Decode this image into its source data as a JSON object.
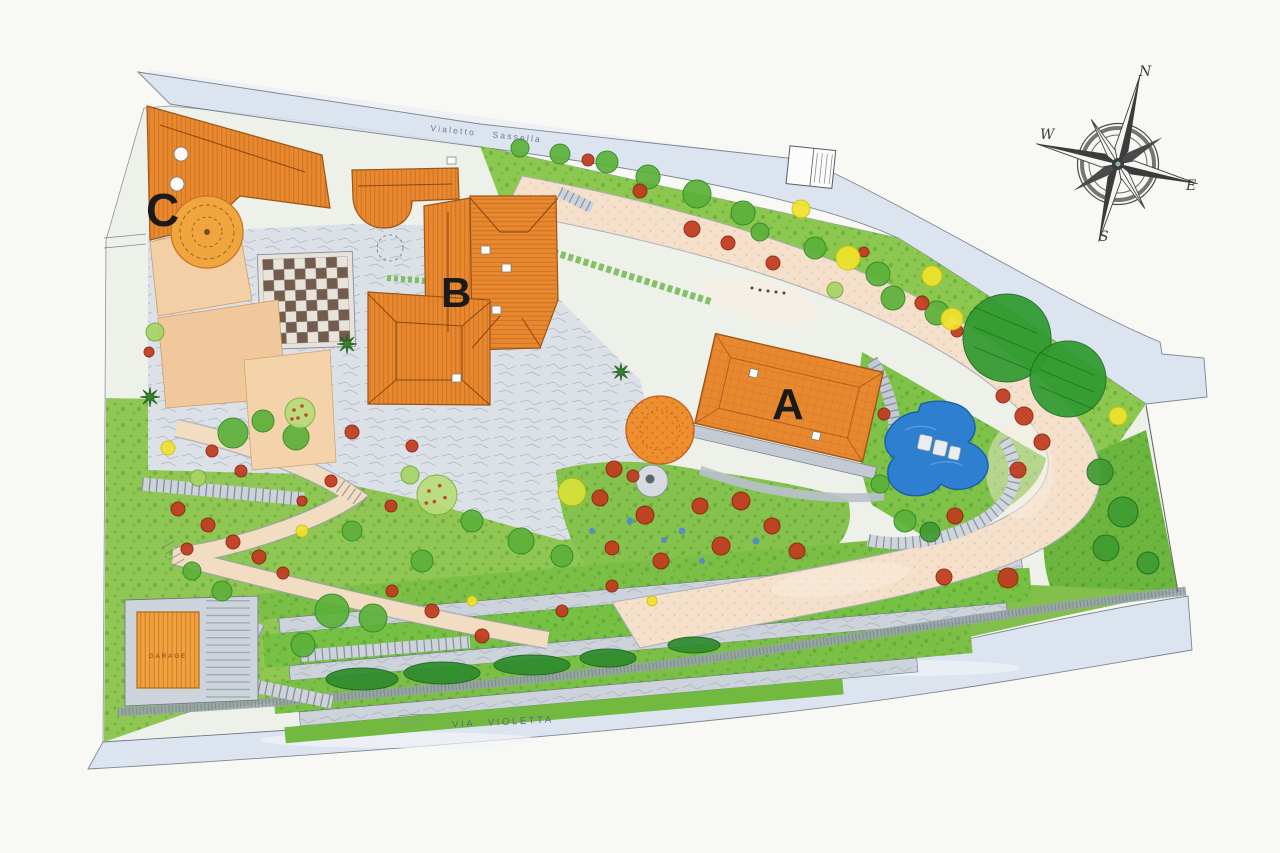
{
  "plan": {
    "type": "hand-drawn landscape site plan",
    "streets": {
      "top": "Vialetto Sassella",
      "bottom": "VIA VIOLETTA"
    },
    "buildings": {
      "a": "A",
      "b": "B",
      "c": "C",
      "garage": "GARAGE"
    },
    "compass": {
      "north": "N",
      "east": "E",
      "south": "S",
      "west": "W"
    },
    "palette": {
      "paper": "#f8f8f5",
      "street_blue": "#d8e2ee",
      "property_base": "#eef0ea",
      "roof_orange": "#e8892f",
      "roof_hatch": "#b85a18",
      "roof_light": "#efa23d",
      "tower_orange": "#f0a53e",
      "terrace_peach": "#f3cfa6",
      "driveway": "#f5e0cb",
      "courtyard_grey": "#dce1e8",
      "path_grey": "#ccd3da",
      "garden_green": "#8cc850",
      "tree_green": "#5cb13a",
      "tree_dark": "#3f9b33",
      "bush_red": "#c13a1e",
      "tree_yellow": "#f0e32b",
      "pool_blue": "#2e7fd0",
      "checker_dark": "#6a5140",
      "checker_light": "#eae4d8",
      "ink": "#1a1a1a"
    },
    "checkerboard": {
      "rows": 8,
      "cols": 8
    },
    "vegetation": [
      [
        "tree",
        520,
        148,
        9
      ],
      [
        "tree",
        560,
        154,
        10
      ],
      [
        "tree",
        607,
        162,
        11
      ],
      [
        "tree",
        648,
        177,
        12
      ],
      [
        "tree",
        697,
        194,
        14
      ],
      [
        "tree",
        743,
        213,
        12
      ],
      [
        "tree",
        815,
        248,
        11
      ],
      [
        "tree",
        878,
        274,
        12
      ],
      [
        "tree",
        893,
        298,
        12
      ],
      [
        "tree",
        937,
        313,
        12
      ],
      [
        "tree",
        760,
        232,
        9
      ],
      [
        "bush-red",
        588,
        160,
        6
      ],
      [
        "bush-red",
        640,
        191,
        7
      ],
      [
        "bush-red",
        692,
        229,
        8
      ],
      [
        "bush-red",
        728,
        243,
        7
      ],
      [
        "bush-red",
        773,
        263,
        7
      ],
      [
        "bush-red",
        864,
        252,
        5
      ],
      [
        "bush-red",
        922,
        303,
        7
      ],
      [
        "bush-red",
        957,
        331,
        6
      ],
      [
        "tree-yellow",
        801,
        209,
        9
      ],
      [
        "tree-yellow",
        848,
        258,
        12
      ],
      [
        "tree-yellow",
        932,
        276,
        10
      ],
      [
        "tree-yellow",
        952,
        319,
        11
      ],
      [
        "tree-yellow",
        1118,
        416,
        9
      ],
      [
        "tree-big",
        1007,
        338,
        44
      ],
      [
        "tree-big",
        1068,
        379,
        38
      ],
      [
        "tree-light",
        835,
        290,
        8
      ],
      [
        "bush-red",
        1003,
        396,
        7
      ],
      [
        "bush-red",
        1024,
        416,
        9
      ],
      [
        "bush-red",
        1042,
        442,
        8
      ],
      [
        "bush-red",
        955,
        516,
        8
      ],
      [
        "bush-red",
        884,
        414,
        6
      ],
      [
        "bush-red",
        1018,
        470,
        8
      ],
      [
        "tree",
        905,
        521,
        11
      ],
      [
        "tree",
        880,
        484,
        9
      ],
      [
        "tree-dark",
        930,
        532,
        10
      ],
      [
        "tree-dark",
        1100,
        472,
        13
      ],
      [
        "tree-dark",
        1123,
        512,
        15
      ],
      [
        "tree-dark",
        1106,
        548,
        13
      ],
      [
        "tree-dark",
        1148,
        563,
        11
      ],
      [
        "bush-red",
        1008,
        578,
        10
      ],
      [
        "bush-red",
        944,
        577,
        8
      ],
      [
        "bush-yellow",
        572,
        492,
        14
      ],
      [
        "bush-red",
        600,
        498,
        8
      ],
      [
        "bush-red",
        645,
        515,
        9
      ],
      [
        "bush-red",
        700,
        506,
        8
      ],
      [
        "bush-red",
        741,
        501,
        9
      ],
      [
        "bush-red",
        772,
        526,
        8
      ],
      [
        "bush-red",
        721,
        546,
        9
      ],
      [
        "bush-red",
        661,
        561,
        8
      ],
      [
        "bush-red",
        612,
        548,
        7
      ],
      [
        "bush-red",
        797,
        551,
        8
      ],
      [
        "bush-red",
        614,
        469,
        8
      ],
      [
        "bush-red",
        633,
        476,
        6
      ],
      [
        "dot-blue",
        630,
        521,
        3.5
      ],
      [
        "dot-blue",
        682,
        531,
        3.5
      ],
      [
        "dot-blue",
        756,
        541,
        3.5
      ],
      [
        "dot-blue",
        702,
        561,
        3
      ],
      [
        "dot-blue",
        592,
        531,
        3
      ],
      [
        "dot-blue",
        664,
        540,
        3
      ],
      [
        "tree",
        233,
        433,
        15
      ],
      [
        "tree",
        296,
        437,
        13
      ],
      [
        "tree",
        263,
        421,
        11
      ],
      [
        "tree",
        332,
        611,
        17
      ],
      [
        "tree",
        373,
        618,
        14
      ],
      [
        "tree",
        303,
        645,
        12
      ],
      [
        "tree",
        472,
        521,
        11
      ],
      [
        "tree",
        521,
        541,
        13
      ],
      [
        "tree",
        562,
        556,
        11
      ],
      [
        "tree",
        422,
        561,
        11
      ],
      [
        "tree",
        352,
        531,
        10
      ],
      [
        "tree",
        222,
        591,
        10
      ],
      [
        "tree",
        192,
        571,
        9
      ],
      [
        "tree-fruit",
        437,
        495,
        20
      ],
      [
        "tree-fruit",
        300,
        413,
        15
      ],
      [
        "tree-light",
        410,
        475,
        9
      ],
      [
        "tree-light",
        198,
        478,
        8
      ],
      [
        "tree-light",
        155,
        332,
        9
      ],
      [
        "bush-red",
        149,
        352,
        5
      ],
      [
        "bush-red",
        178,
        509,
        7
      ],
      [
        "bush-red",
        208,
        525,
        7
      ],
      [
        "bush-red",
        233,
        542,
        7
      ],
      [
        "bush-red",
        259,
        557,
        7
      ],
      [
        "bush-red",
        187,
        549,
        6
      ],
      [
        "bush-red",
        283,
        573,
        6
      ],
      [
        "bush-red",
        241,
        471,
        6
      ],
      [
        "bush-red",
        212,
        451,
        6
      ],
      [
        "bush-red",
        331,
        481,
        6
      ],
      [
        "bush-red",
        391,
        506,
        6
      ],
      [
        "bush-red",
        302,
        501,
        5
      ],
      [
        "bush-red",
        432,
        611,
        7
      ],
      [
        "bush-red",
        392,
        591,
        6
      ],
      [
        "bush-red",
        482,
        636,
        7
      ],
      [
        "bush-red",
        562,
        611,
        6
      ],
      [
        "bush-red",
        352,
        432,
        7
      ],
      [
        "bush-red",
        412,
        446,
        6
      ],
      [
        "bush-red",
        612,
        586,
        6
      ],
      [
        "tree-yellow",
        302,
        531,
        6
      ],
      [
        "tree-yellow",
        472,
        601,
        5
      ],
      [
        "tree-yellow",
        168,
        448,
        7
      ],
      [
        "tree-yellow",
        652,
        601,
        5
      ],
      [
        "palm",
        150,
        397,
        10
      ],
      [
        "palm",
        347,
        344,
        10
      ],
      [
        "palm",
        621,
        372,
        9
      ],
      [
        "hedge",
        362,
        679,
        36,
        11
      ],
      [
        "hedge",
        442,
        673,
        38,
        11
      ],
      [
        "hedge",
        532,
        665,
        38,
        10
      ],
      [
        "hedge",
        608,
        658,
        28,
        9
      ],
      [
        "hedge",
        694,
        645,
        26,
        8
      ],
      [
        "dot-black",
        752,
        288,
        1.5
      ],
      [
        "dot-black",
        760,
        290,
        1.5
      ],
      [
        "dot-black",
        768,
        291,
        1.5
      ],
      [
        "dot-black",
        776,
        292,
        1.5
      ],
      [
        "dot-black",
        784,
        293,
        1.5
      ]
    ]
  }
}
